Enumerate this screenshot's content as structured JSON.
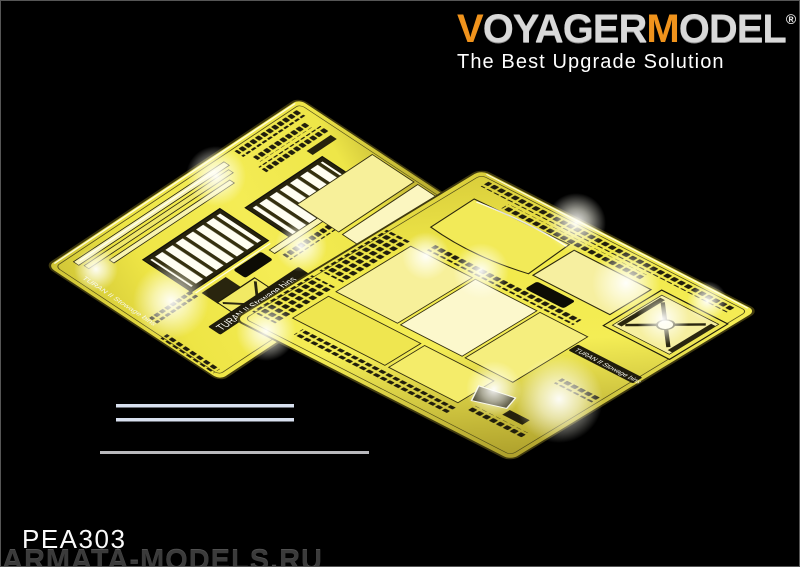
{
  "window": {
    "width_px": 800,
    "height_px": 567,
    "background_color": "#000000",
    "frame_color": "#565656"
  },
  "logo": {
    "brand_segments": [
      {
        "text": "V",
        "color": "#f0931c"
      },
      {
        "text": "OYAGER",
        "color": "#d9d9d9"
      },
      {
        "text": "M",
        "color": "#f0931c"
      },
      {
        "text": "ODEL",
        "color": "#d9d9d9"
      }
    ],
    "registered_mark": "®",
    "tagline": "The Best Upgrade Solution",
    "tagline_color": "#ffffff"
  },
  "product": {
    "code": "PEA303"
  },
  "watermark": {
    "text": "ARMATA-MODELS.RU",
    "color": "#3b3b3b"
  },
  "frets": [
    {
      "name": "left photo-etch fret",
      "etched_label": "TURAN II Stowage bins",
      "metal_color": "#f2ea48",
      "etch_color": "#211e0c"
    },
    {
      "name": "right photo-etch fret",
      "etched_label": "TURAN II Stowage bins",
      "metal_color": "#f2ea48",
      "etch_color": "#211e0c"
    }
  ],
  "scale_lines": {
    "count": 3,
    "short_line_color": "#d8e0ef",
    "long_line_color": "#b9b9bd"
  }
}
